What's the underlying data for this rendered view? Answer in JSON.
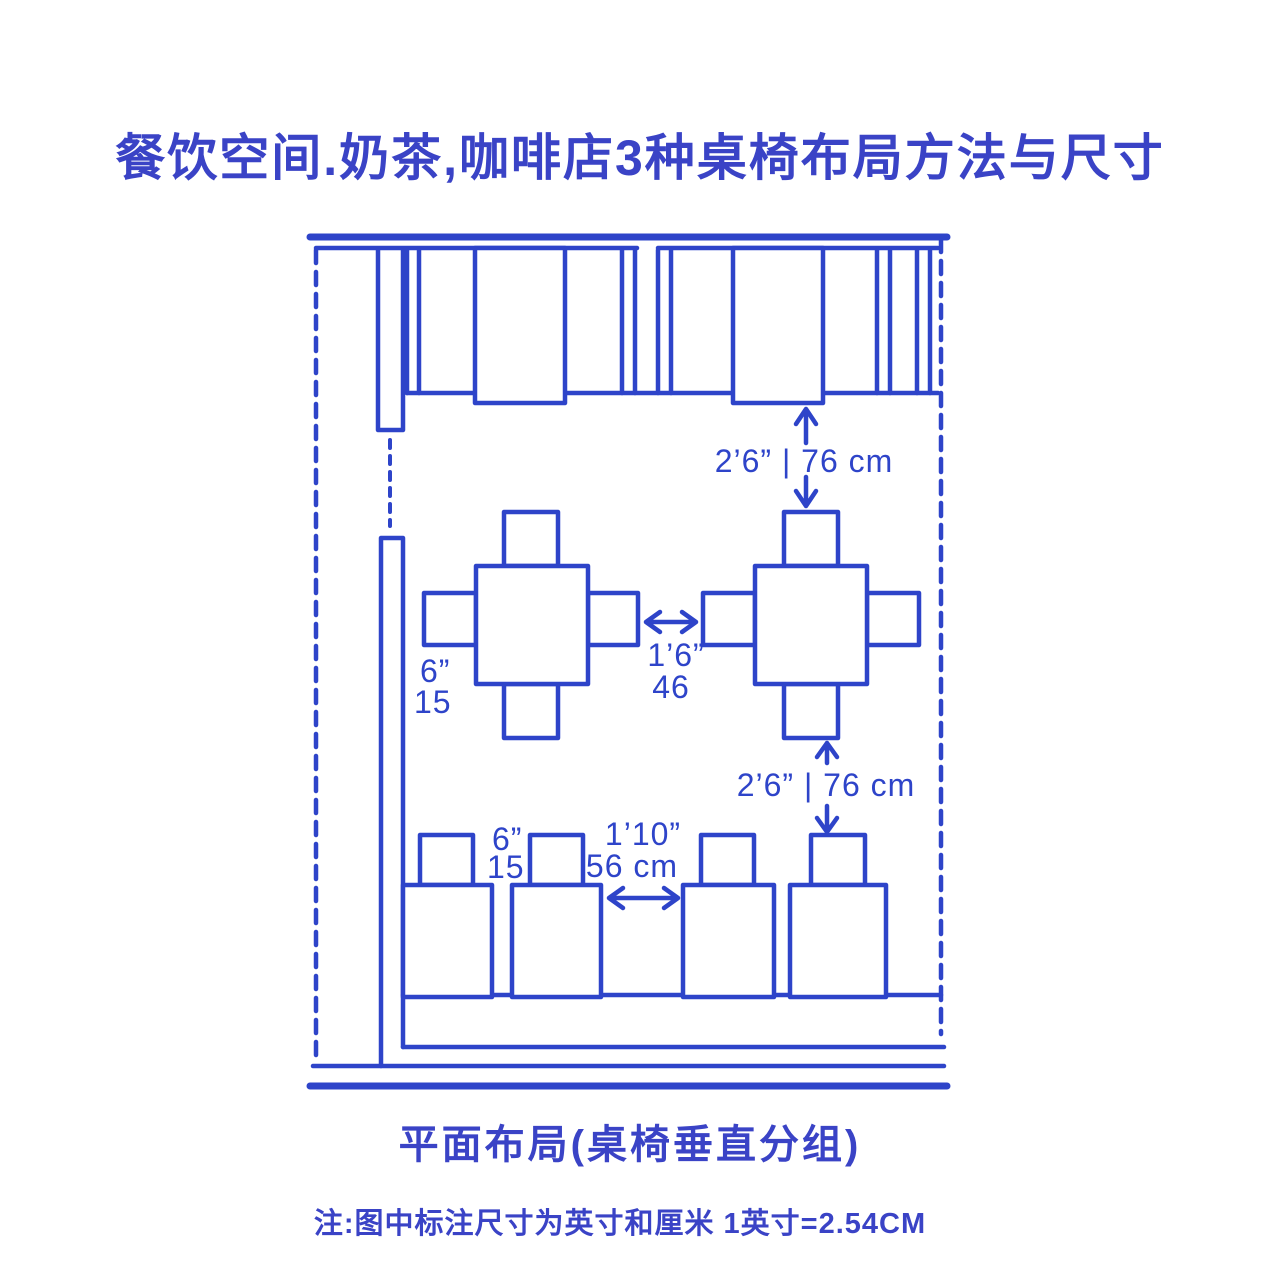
{
  "title": "餐饮空间.奶茶,咖啡店3种桌椅布局方法与尺寸",
  "caption": "平面布局(桌椅垂直分组)",
  "note": "注:图中标注尺寸为英寸和厘米 1英寸=2.54CM",
  "colors": {
    "ink": "#2e44c9",
    "title_ink": "#3a43c6",
    "background": "#ffffff"
  },
  "annotations": {
    "booth_to_table_gap": "2’6” | 76 cm",
    "table_to_row_gap": "2’6” | 76 cm",
    "mid_chair_offset_in": "6”",
    "mid_chair_offset_cm": "15",
    "mid_table_spacing_in": "1’6”",
    "mid_table_spacing_cm": "46",
    "row_chair_offset_in": "6”",
    "row_chair_offset_cm": "15",
    "row_table_spacing_in": "1’10”",
    "row_table_spacing_cm": "56 cm"
  }
}
